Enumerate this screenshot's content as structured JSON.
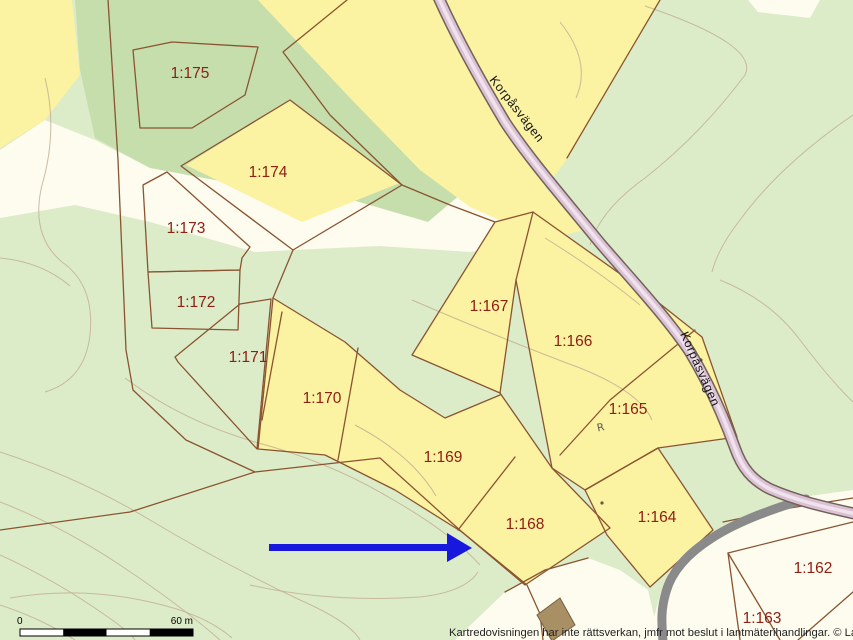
{
  "map": {
    "parcels": {
      "p175": "1:175",
      "p174": "1:174",
      "p173": "1:173",
      "p172": "1:172",
      "p171": "1:171",
      "p170": "1:170",
      "p169": "1:169",
      "p168": "1:168",
      "p167": "1:167",
      "p166": "1:166",
      "p165": "1:165",
      "p164": "1:164",
      "p163": "1:163",
      "p162": "1:162"
    },
    "road_name": "Korpåsvägen",
    "monument_symbol": "R",
    "colors": {
      "background_green": "#dcecc9",
      "forest_green": "#c5deac",
      "parcel_yellow": "#fbf2a2",
      "open_land_white": "#fdfcef",
      "boundary_brown": "#8a5430",
      "label_red": "#8e2014",
      "road_pink": "#dcc0d4",
      "minor_road_gray": "#8a8a8a",
      "arrow_blue": "#1717dd"
    }
  },
  "scale_bar": {
    "zero_label": "0",
    "distance_label": "60 m"
  },
  "footer": {
    "disclaimer": "Kartredovisningen har inte rättsverkan, jmfr mot beslut i lantmäterihandlingar. © Lantmäteriet"
  }
}
